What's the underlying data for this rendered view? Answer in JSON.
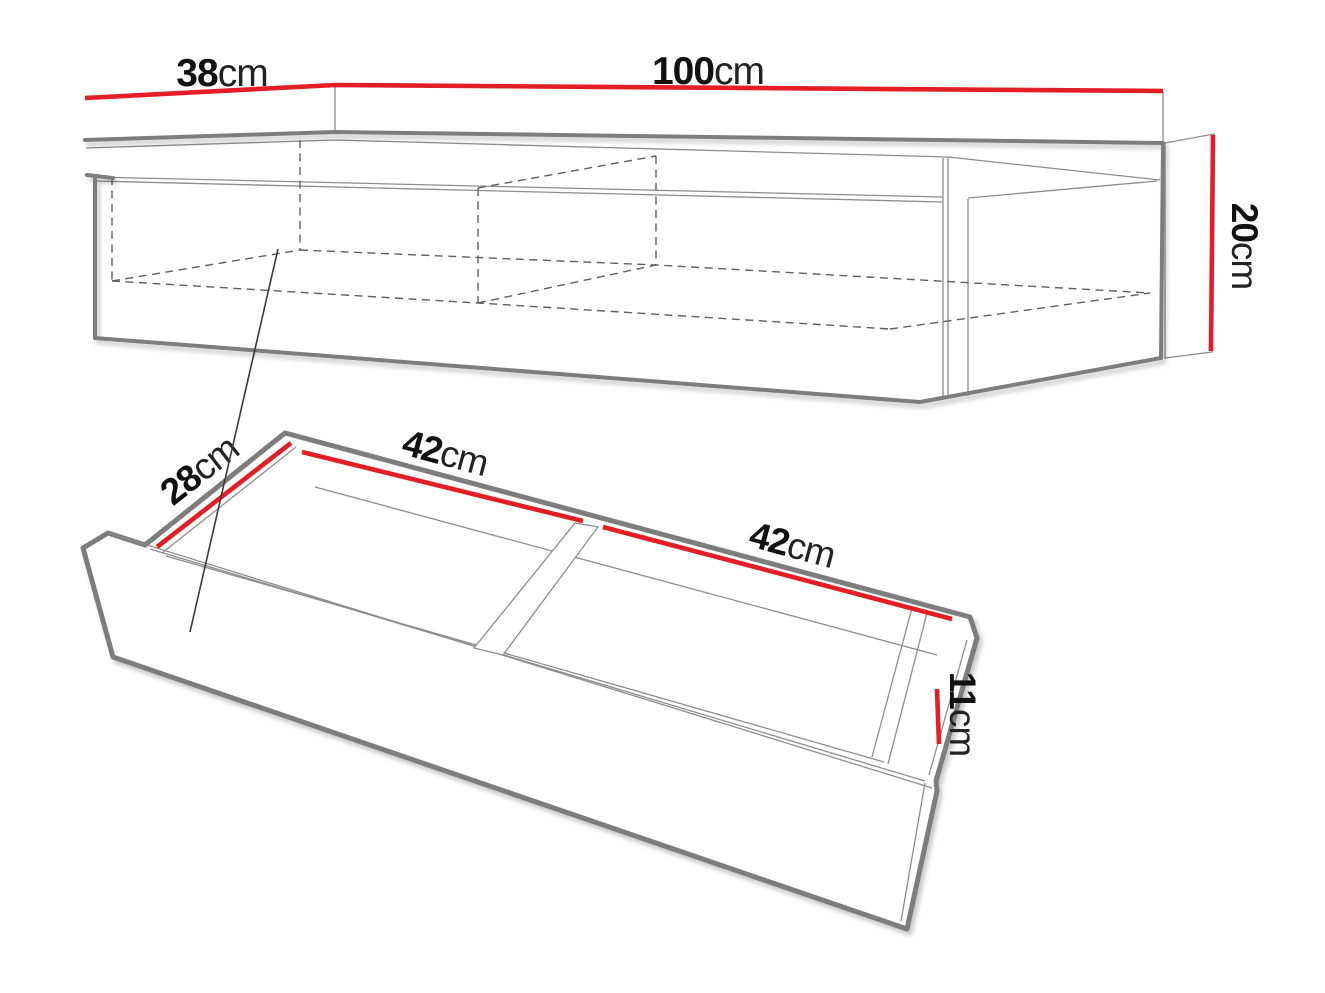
{
  "page": {
    "background": "#ffffff"
  },
  "colors": {
    "dimension_line": "#e31e24",
    "outline": "#7d7d7d",
    "detail_line": "#8d8d8d",
    "leader_line": "#3a3a3a",
    "label_text": "#111111"
  },
  "cabinet": {
    "depth_label": {
      "value": "38",
      "unit": "cm"
    },
    "width_label": {
      "value": "100",
      "unit": "cm"
    },
    "height_label": {
      "value": "20",
      "unit": "cm"
    }
  },
  "drawer": {
    "depth_label": {
      "value": "28",
      "unit": "cm"
    },
    "left_compartment_label": {
      "value": "42",
      "unit": "cm"
    },
    "right_compartment_label": {
      "value": "42",
      "unit": "cm"
    },
    "height_label": {
      "value": "11",
      "unit": "cm"
    }
  }
}
